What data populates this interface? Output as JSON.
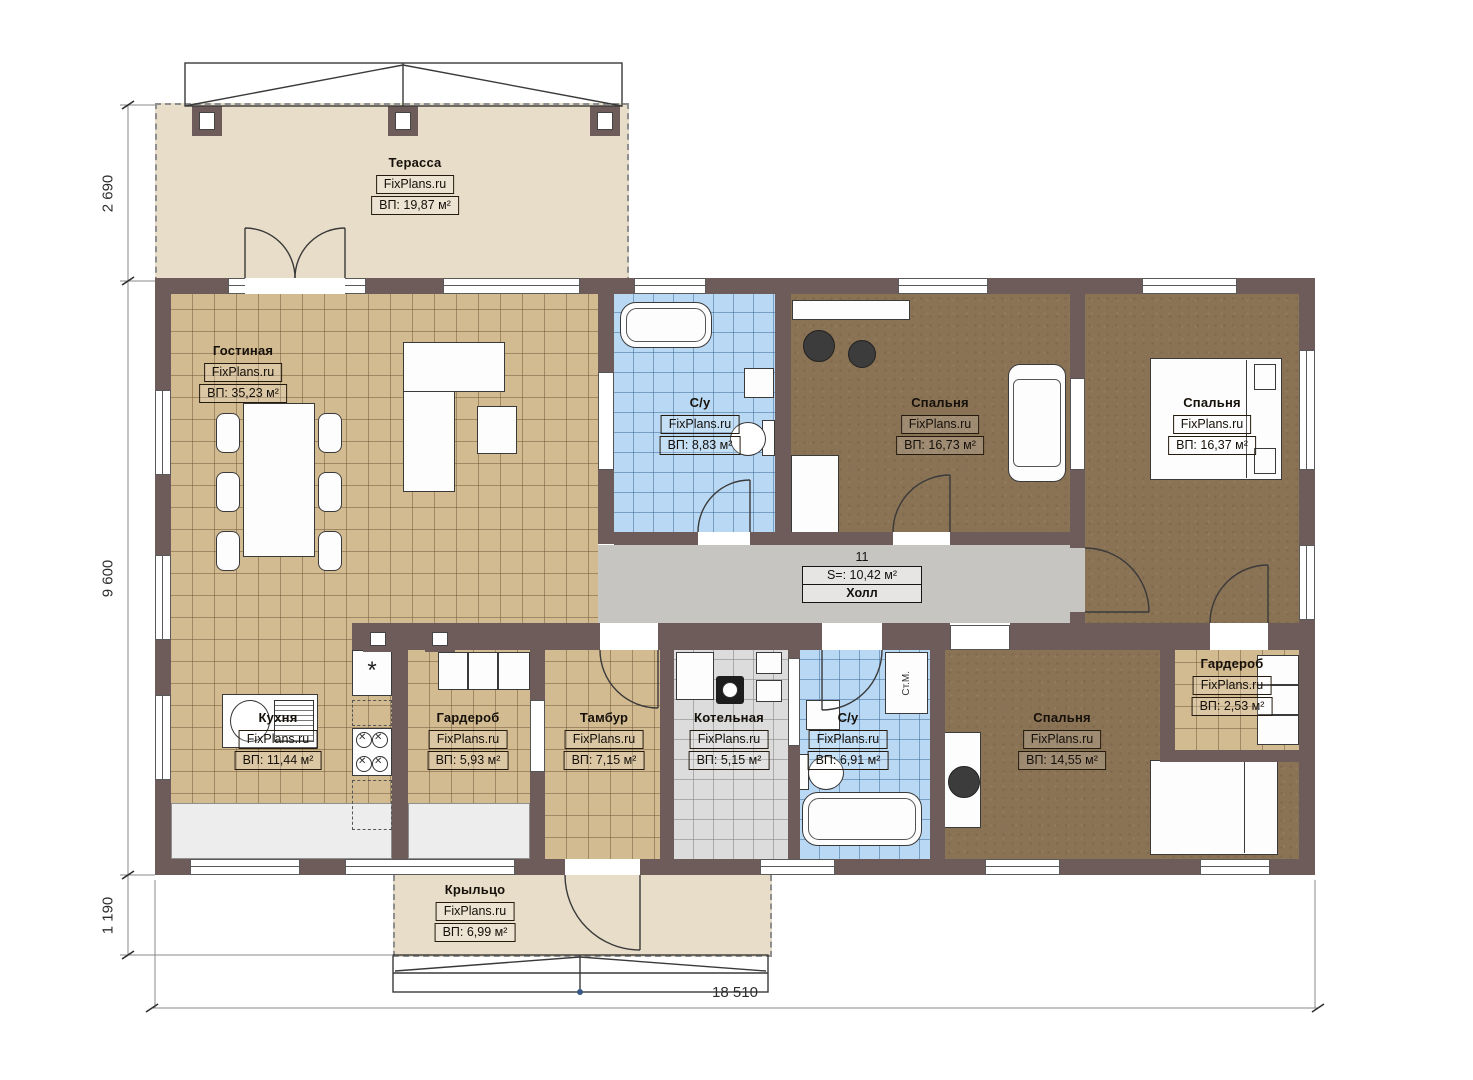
{
  "colors": {
    "wall": "#6e5c5b",
    "tanFloor": "#d3bb91",
    "blueFloor": "#b9d8f3",
    "brownFloor": "#8a7254",
    "hallFloor": "#c7c5c2",
    "beige": "#e8ddc8"
  },
  "rooms": [
    {
      "name": "Терасса",
      "watermark": "FixPlans.ru",
      "area": "ВП: 19,87 м²"
    },
    {
      "name": "Гостиная",
      "watermark": "FixPlans.ru",
      "area": "ВП: 35,23 м²"
    },
    {
      "name": "С/у",
      "watermark": "FixPlans.ru",
      "area": "ВП: 8,83 м²"
    },
    {
      "name": "Спальня",
      "watermark": "FixPlans.ru",
      "area": "ВП: 16,73 м²"
    },
    {
      "name": "Спальня",
      "watermark": "FixPlans.ru",
      "area": "ВП: 16,37 м²"
    },
    {
      "name": "Холл",
      "number": "11",
      "area": "S=: 10,42 м²"
    },
    {
      "name": "Кухня",
      "watermark": "FixPlans.ru",
      "area": "ВП: 11,44 м²"
    },
    {
      "name": "Гардероб",
      "watermark": "FixPlans.ru",
      "area": "ВП: 5,93 м²"
    },
    {
      "name": "Тамбур",
      "watermark": "FixPlans.ru",
      "area": "ВП: 7,15 м²"
    },
    {
      "name": "Котельная",
      "watermark": "FixPlans.ru",
      "area": "ВП: 5,15 м²"
    },
    {
      "name": "С/у",
      "watermark": "FixPlans.ru",
      "area": "ВП: 6,91 м²"
    },
    {
      "name": "Спальня",
      "watermark": "FixPlans.ru",
      "area": "ВП: 14,55 м²"
    },
    {
      "name": "Гардероб",
      "watermark": "FixPlans.ru",
      "area": "ВП: 2,53 м²"
    },
    {
      "name": "Крыльцо",
      "watermark": "FixPlans.ru",
      "area": "ВП: 6,99 м²"
    }
  ],
  "dimensions": {
    "left_top": "2 690",
    "left_main": "9 600",
    "left_bottom": "1 190",
    "bottom_total": "18 510"
  },
  "appliances": {
    "washing_machine": "Ст.М.",
    "fridge_symbol": "*"
  }
}
